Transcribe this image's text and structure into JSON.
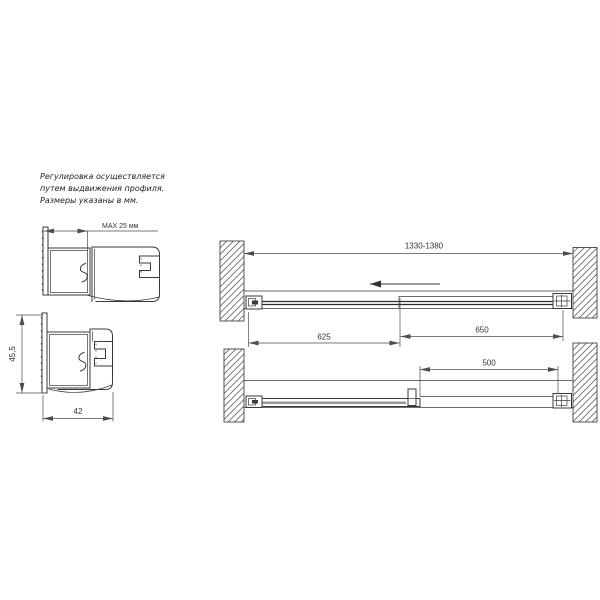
{
  "note": {
    "line1": "Регулировка осуществляется",
    "line2": "путем выдвижения профиля.",
    "line3": "Размеры указаны в мм."
  },
  "profile_extended": {
    "dim_label": "MAX 25 мм"
  },
  "profile_retracted": {
    "height_label": "45,5",
    "width_label": "42"
  },
  "plan_closed": {
    "total_width_label": "1330-1380",
    "door_panel_label": "625",
    "fixed_panel_label": "650"
  },
  "plan_open": {
    "opening_label": "500"
  },
  "colors": {
    "line": "#3a3a3a",
    "dimension": "#4d4d4d",
    "glass": "#999999",
    "hatch": "#666666",
    "background": "#ffffff"
  }
}
